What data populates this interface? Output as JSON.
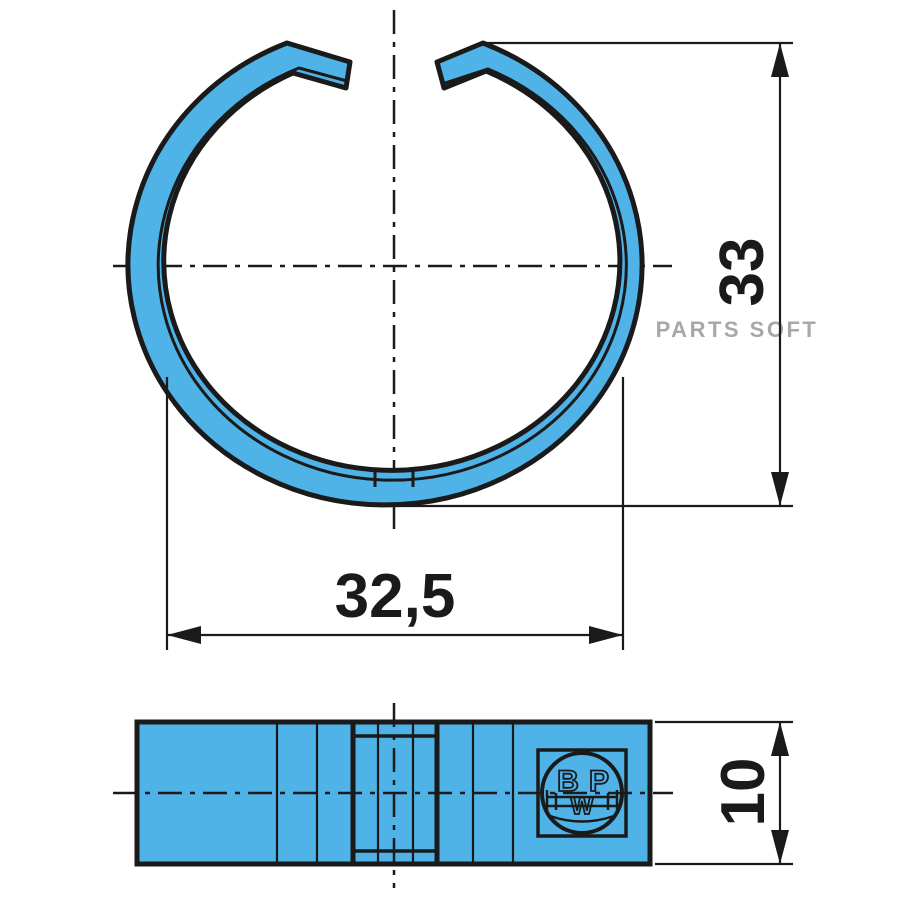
{
  "drawing": {
    "dimensions": {
      "outer_height": "33",
      "inner_diameter": "32,5",
      "band_width": "10"
    },
    "watermark": "PARTS SOFT",
    "logo": {
      "b": "B",
      "p": "P",
      "w": "W"
    },
    "colors": {
      "part_fill": "#4fb3e8",
      "line": "#1a1a1a",
      "watermark": "#a8a8a8"
    }
  }
}
